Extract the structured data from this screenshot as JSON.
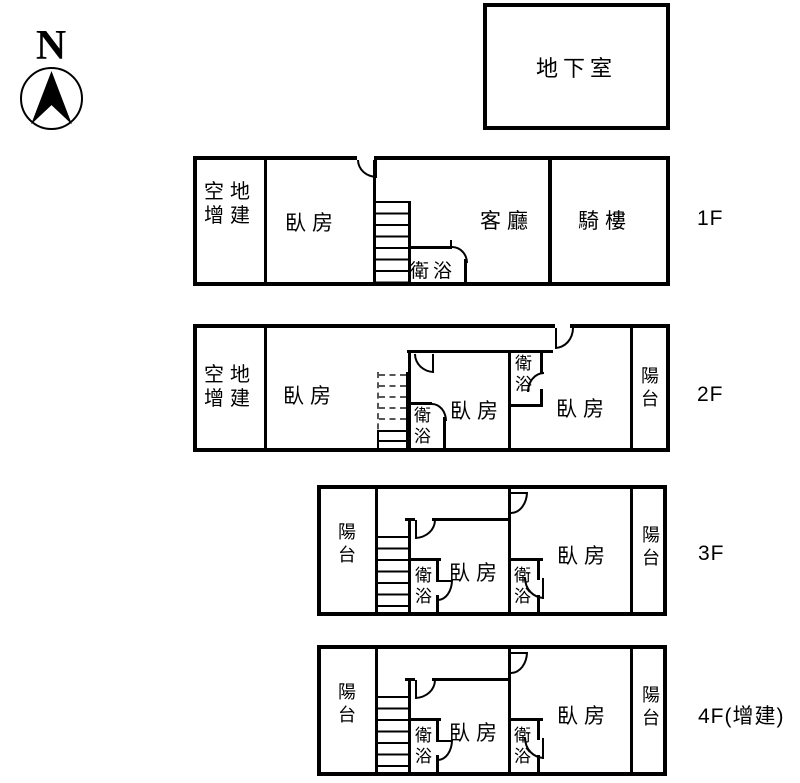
{
  "compass": {
    "north": "N"
  },
  "basement": {
    "label": "地下室"
  },
  "floor1": {
    "tag": "1F",
    "vacant_line1": "空地",
    "vacant_line2": "增建",
    "bedroom": "臥房",
    "bathroom": "衛浴",
    "living_room": "客廳",
    "arcade": "騎樓"
  },
  "floor2": {
    "tag": "2F",
    "vacant_line1": "空地",
    "vacant_line2": "增建",
    "bedroom_left": "臥房",
    "bedroom_mid": "臥房",
    "bedroom_right": "臥房",
    "bathroom_lower": "衛浴",
    "bathroom_upper": "衛浴",
    "balcony": "陽台"
  },
  "floor3": {
    "tag": "3F",
    "balcony_left": "陽台",
    "bedroom_mid": "臥房",
    "bedroom_right": "臥房",
    "bathroom_mid": "衛浴",
    "bathroom_right": "衛浴",
    "balcony_right": "陽台"
  },
  "floor4": {
    "tag": "4F(增建)",
    "balcony_left": "陽台",
    "bedroom_mid": "臥房",
    "bedroom_right": "臥房",
    "bathroom_mid": "衛浴",
    "bathroom_right": "衛浴",
    "balcony_right": "陽台"
  },
  "colors": {
    "line": "#000000",
    "background": "#ffffff"
  }
}
